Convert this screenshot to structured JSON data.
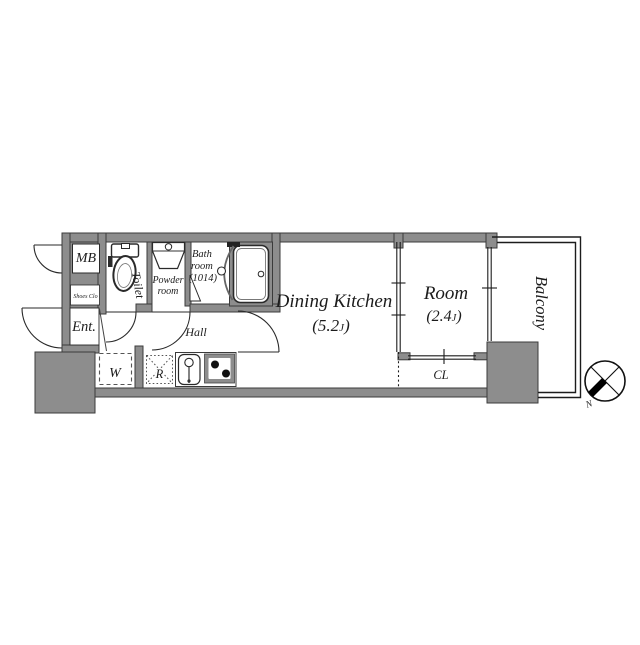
{
  "plan": {
    "title": "apartment-floor-plan",
    "rooms": {
      "mb": {
        "label": "MB"
      },
      "shoes": {
        "label": "Shoes Clo"
      },
      "entrance": {
        "label": "Ent."
      },
      "toilet": {
        "label": "Toilet"
      },
      "powder": {
        "line1": "Powder",
        "line2": "room"
      },
      "bath": {
        "line1": "Bath",
        "line2": "room",
        "line3": "(1014)"
      },
      "hall": {
        "label": "Hall"
      },
      "washer": {
        "label": "W"
      },
      "fridge": {
        "label": "R"
      },
      "dining_kitchen": {
        "label": "Dining Kitchen",
        "size_pre": "(5.2",
        "size_unit": "J",
        "size_post": ")"
      },
      "room": {
        "label": "Room",
        "size_pre": "(2.4",
        "size_unit": "J",
        "size_post": ")"
      },
      "closet": {
        "label": "CL"
      },
      "balcony": {
        "label": "Balcony"
      }
    },
    "compass": {
      "north_label": "N"
    },
    "colors": {
      "wall": "#8d8d8d",
      "wall_stroke": "#3b3b3b",
      "line": "#1c1c1c",
      "background": "#ffffff"
    }
  }
}
